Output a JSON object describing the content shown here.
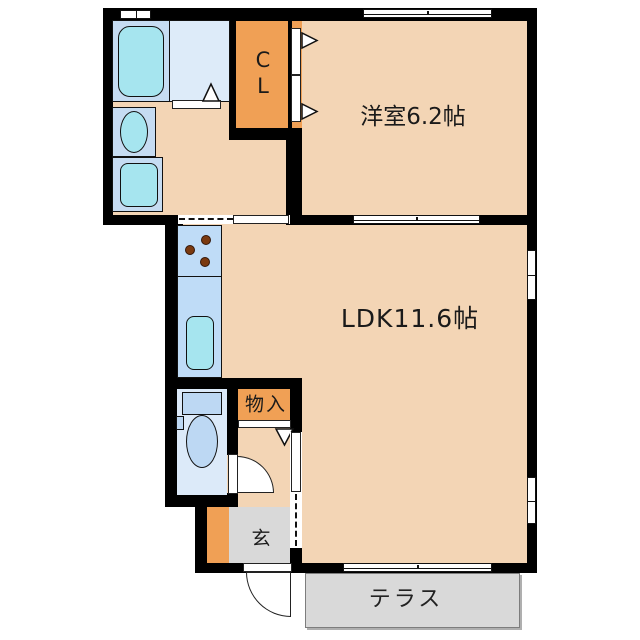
{
  "labels": {
    "western_room": "洋室6.2帖",
    "ldk": "LDK11.6帖",
    "closet_line1": "C",
    "closet_line2": "L",
    "storage": "物入",
    "entrance": "玄",
    "terrace": "テラス"
  },
  "colors": {
    "floor_peach": "#F3D5B5",
    "accent_orange": "#F0A055",
    "water_blue": "#C6DCF2",
    "counter_blue": "#BFDCF7",
    "fixture_cyan": "#A6E5EF",
    "toilet_room_blue": "#DCEAF9",
    "tatami_gray": "#D9D9D9",
    "wall_black": "#000000"
  }
}
